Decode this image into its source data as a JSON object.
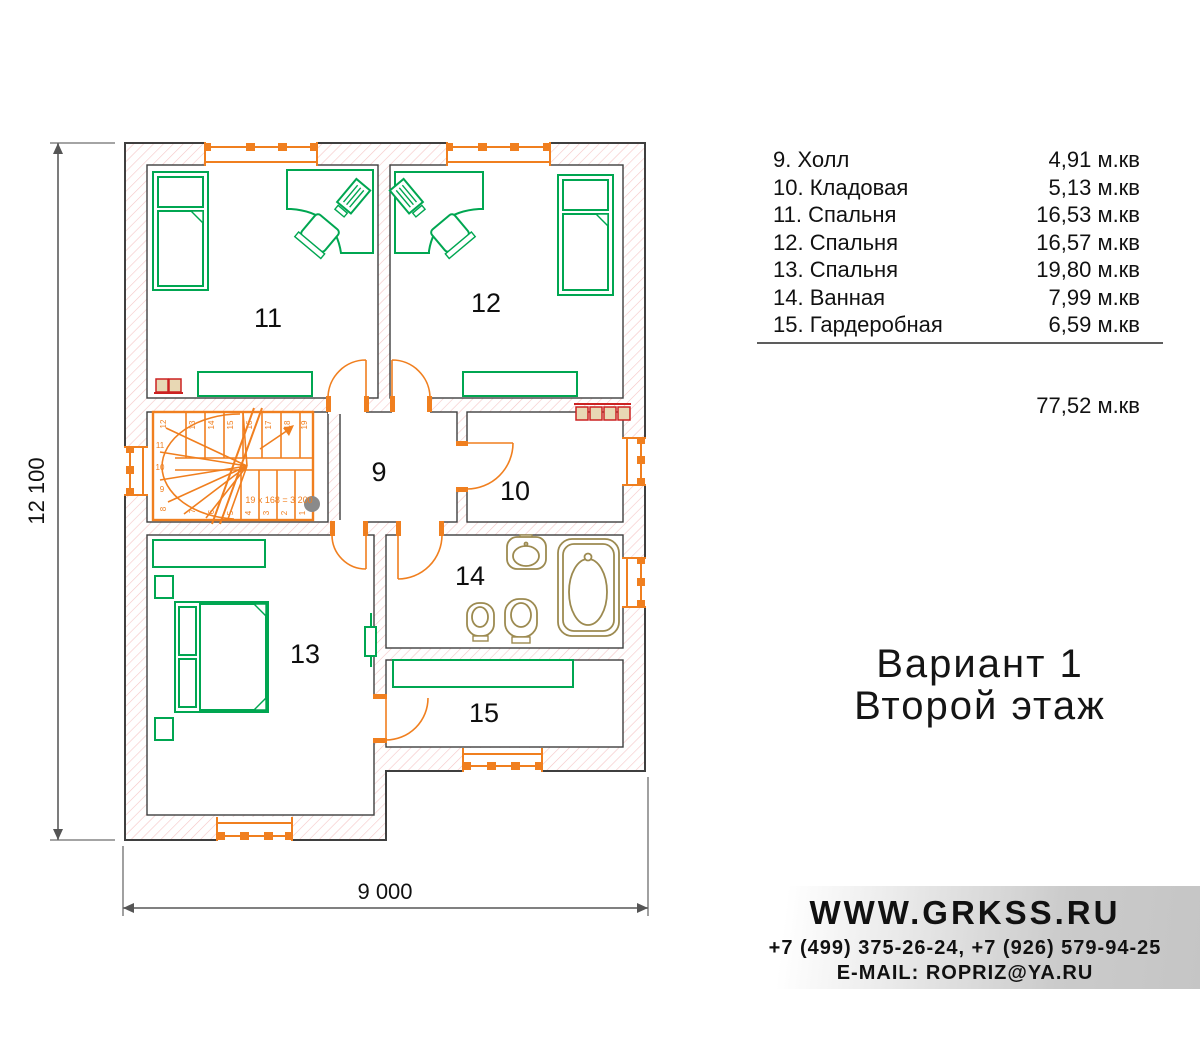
{
  "legend": {
    "rows": [
      {
        "label": "9. Холл",
        "area": "4,91 м.кв"
      },
      {
        "label": "10. Кладовая",
        "area": "5,13 м.кв"
      },
      {
        "label": "11. Спальня",
        "area": "16,53 м.кв"
      },
      {
        "label": "12. Спальня",
        "area": "16,57 м.кв"
      },
      {
        "label": "13. Спальня",
        "area": "19,80 м.кв"
      },
      {
        "label": "14. Ванная",
        "area": "7,99 м.кв"
      },
      {
        "label": "15. Гардеробная",
        "area": "6,59 м.кв"
      }
    ],
    "total": "77,52 м.кв"
  },
  "title": {
    "line1": "Вариант 1",
    "line2": "Второй этаж"
  },
  "footer": {
    "website": "WWW.GRKSS.RU",
    "phones": "+7 (499) 375-26-24, +7 (926) 579-94-25",
    "email": "E-MAIL: ROPRIZ@YA.RU"
  },
  "plan": {
    "dim_width": "9 000",
    "dim_height": "12 100",
    "stair_formula": "19 x 168 = 3 200",
    "rooms": {
      "hall": "9",
      "storage": "10",
      "bedroom11": "11",
      "bedroom12": "12",
      "bedroom13": "13",
      "bathroom": "14",
      "wardrobe": "15"
    },
    "stair_steps": [
      "1",
      "2",
      "3",
      "4",
      "5",
      "6",
      "7",
      "8",
      "9",
      "10",
      "11",
      "12",
      "13",
      "14",
      "15",
      "16",
      "17",
      "18",
      "19"
    ]
  },
  "colors": {
    "wall": "#3f3f3f",
    "hatch": "#f5c6c6",
    "joinery_orange": "#f07f1f",
    "furniture_green": "#00a651",
    "sanitary_olive": "#9c8a50",
    "alert_red": "#cc2222",
    "dimension_gray": "#6e6e6e"
  }
}
